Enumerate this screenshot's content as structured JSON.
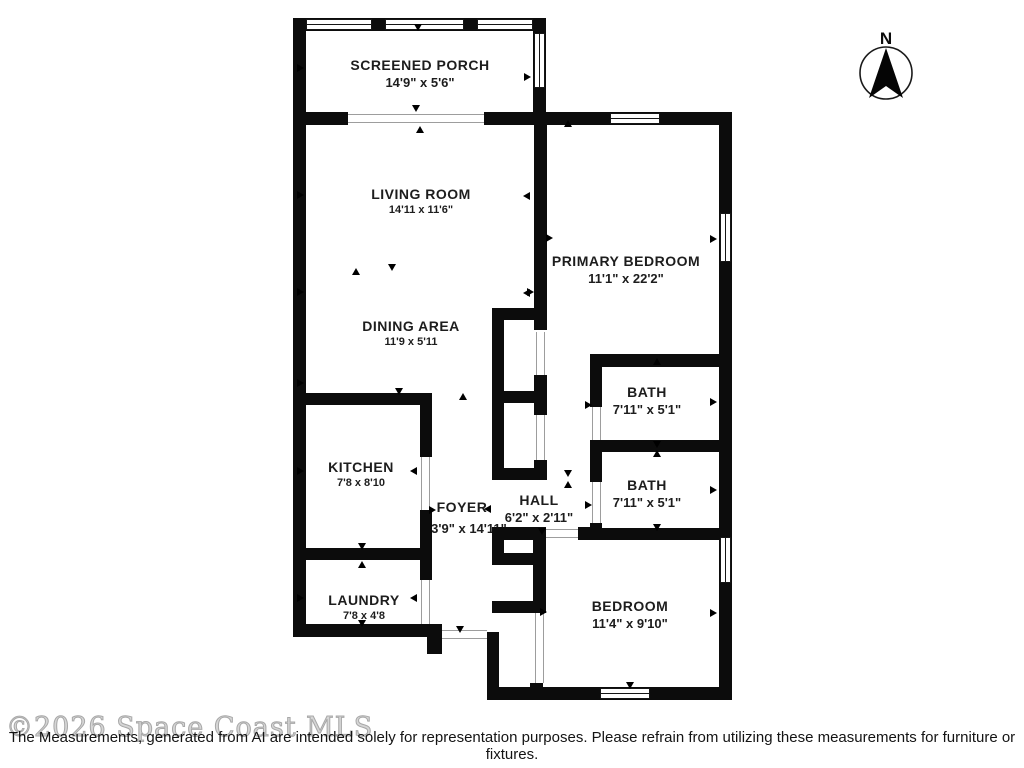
{
  "compass": {
    "label": "N"
  },
  "rooms": [
    {
      "id": "screened-porch",
      "name": "SCREENED PORCH",
      "dims": "14'9\" x 5'6\""
    },
    {
      "id": "living-room",
      "name": "LIVING ROOM",
      "dims": "14'11 x 11'6\""
    },
    {
      "id": "primary-bedroom",
      "name": "PRIMARY BEDROOM",
      "dims": "11'1\" x 22'2\""
    },
    {
      "id": "dining-area",
      "name": "DINING AREA",
      "dims": "11'9 x 5'11"
    },
    {
      "id": "kitchen",
      "name": "KITCHEN",
      "dims": "7'8 x 8'10"
    },
    {
      "id": "bath-upper",
      "name": "BATH",
      "dims": "7'11\" x 5'1\""
    },
    {
      "id": "bath-lower",
      "name": "BATH",
      "dims": "7'11\" x 5'1\""
    },
    {
      "id": "hall",
      "name": "HALL",
      "dims": "6'2\" x 2'11\""
    },
    {
      "id": "foyer",
      "name": "FOYER",
      "dims": "3'9\" x 14'11\""
    },
    {
      "id": "laundry",
      "name": "LAUNDRY",
      "dims": "7'8 x 4'8"
    },
    {
      "id": "bedroom",
      "name": "BEDROOM",
      "dims": "11'4\" x 9'10\""
    }
  ],
  "watermark": "©2026 Space Coast MLS",
  "disclaimer": "The Measurements, generated from AI are intended solely for representation purposes. Please refrain from utilizing these measurements for furniture or fixtures.",
  "colors": {
    "wall": "#0c0c0c",
    "text": "#1d1d1d",
    "watermark": "#c9c9c9"
  }
}
